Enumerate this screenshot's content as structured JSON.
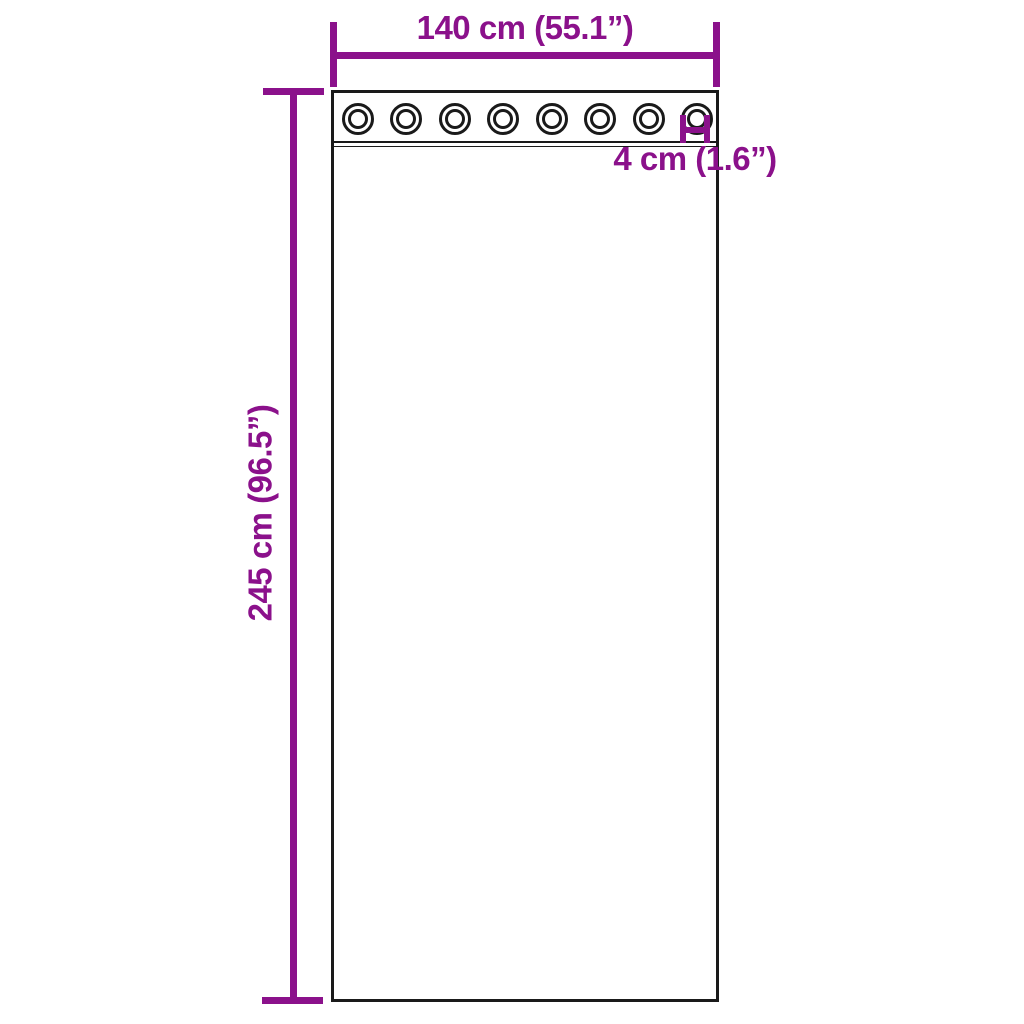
{
  "diagram": {
    "type": "product-dimension-diagram",
    "subject": "sheer curtain panel with grommets",
    "colors": {
      "dimension_accent": "#8B118B",
      "outline_ink": "#1a1a1a",
      "background": "#ffffff"
    },
    "grommets": {
      "count": 8
    },
    "dimensions": {
      "width_label": "140 cm (55.1”)",
      "height_label": "245 cm (96.5”)",
      "grommet_diameter_label": "4 cm (1.6”)"
    }
  }
}
